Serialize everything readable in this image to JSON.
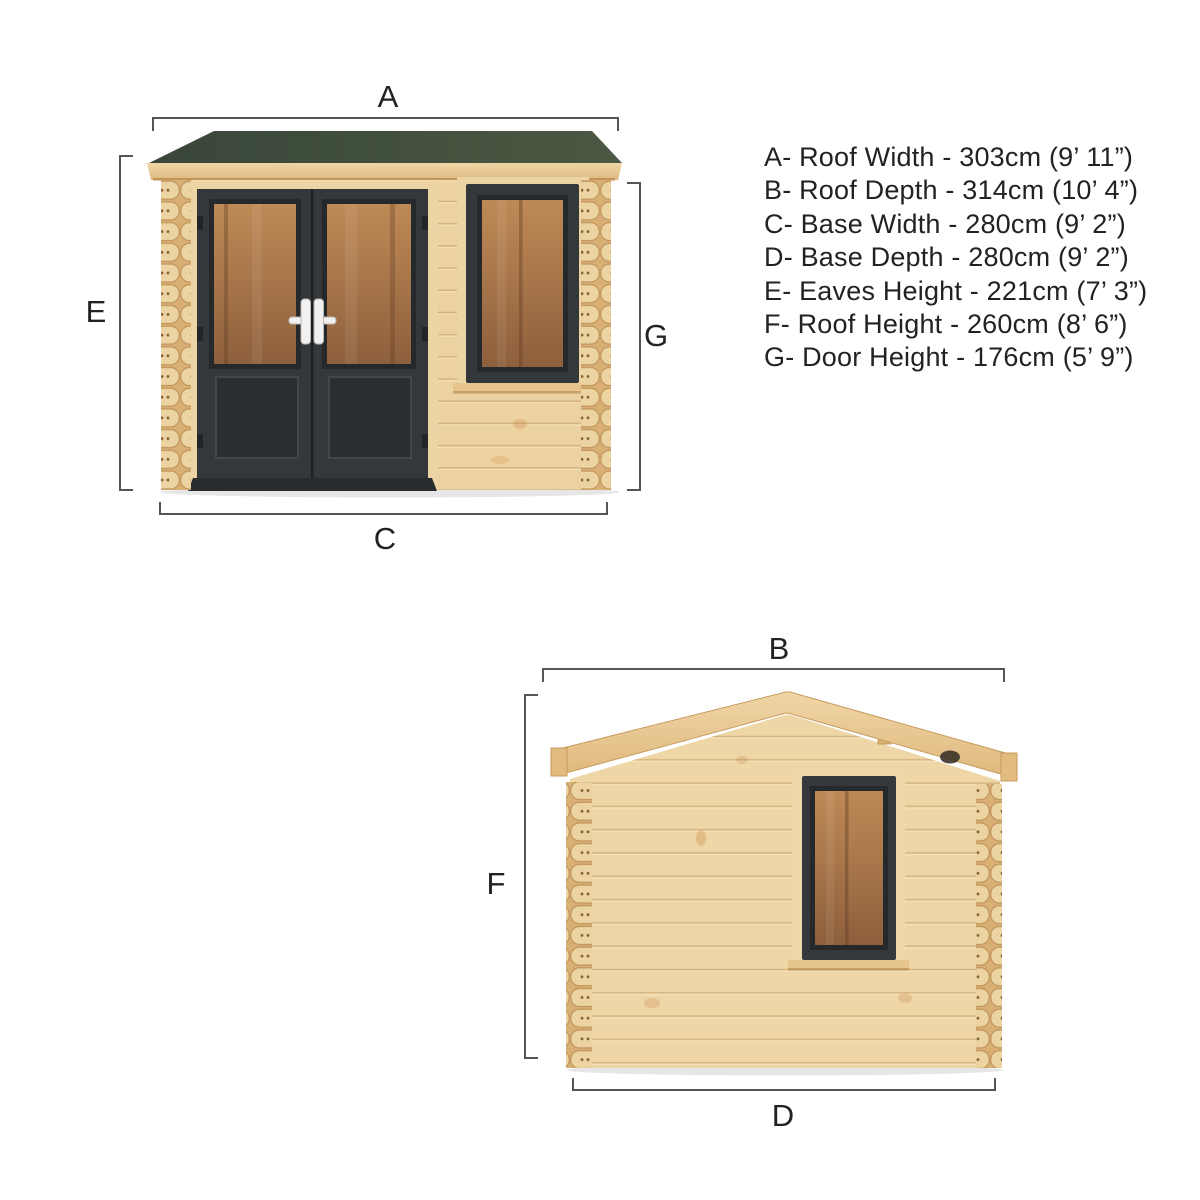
{
  "page": {
    "background": "#ffffff",
    "description": "Log cabin dimension diagram with front and side elevations"
  },
  "legend": {
    "items": [
      {
        "letter": "A",
        "label": "Roof Width",
        "value": "303cm (9’ 11”)",
        "text": "A- Roof Width - 303cm (9’ 11”)"
      },
      {
        "letter": "B",
        "label": "Roof Depth",
        "value": "314cm (10’ 4”)",
        "text": "B- Roof Depth - 314cm (10’ 4”)"
      },
      {
        "letter": "C",
        "label": "Base Width",
        "value": "280cm (9’ 2”)",
        "text": "C- Base Width - 280cm (9’ 2”)"
      },
      {
        "letter": "D",
        "label": "Base Depth",
        "value": "280cm (9’ 2”)",
        "text": "D- Base Depth - 280cm (9’ 2”)"
      },
      {
        "letter": "E",
        "label": "Eaves Height",
        "value": "221cm (7’ 3”)",
        "text": "E- Eaves Height - 221cm (7’ 3”)"
      },
      {
        "letter": "F",
        "label": "Roof Height",
        "value": "260cm (8’ 6”)",
        "text": "F- Roof Height - 260cm (8’ 6”)"
      },
      {
        "letter": "G",
        "label": "Door Height",
        "value": "176cm (5’ 9”)",
        "text": "G- Door Height - 176cm (5’ 9”)"
      }
    ]
  },
  "front_view": {
    "name": "Front elevation",
    "dim_labels": {
      "top": "A",
      "left": "E",
      "bottom": "C",
      "right": "G"
    }
  },
  "side_view": {
    "name": "Side elevation",
    "dim_labels": {
      "top": "B",
      "left": "F",
      "bottom": "D"
    }
  },
  "colors": {
    "roof_green": "#41503d",
    "wood_light": "#ecd09c",
    "wood_mid": "#e2bc7f",
    "frame_dark": "#35383b",
    "glass_amber": "#a9764a",
    "handle_white": "#f2f1ef",
    "dimension_line": "#55565a",
    "text": "#212224"
  }
}
